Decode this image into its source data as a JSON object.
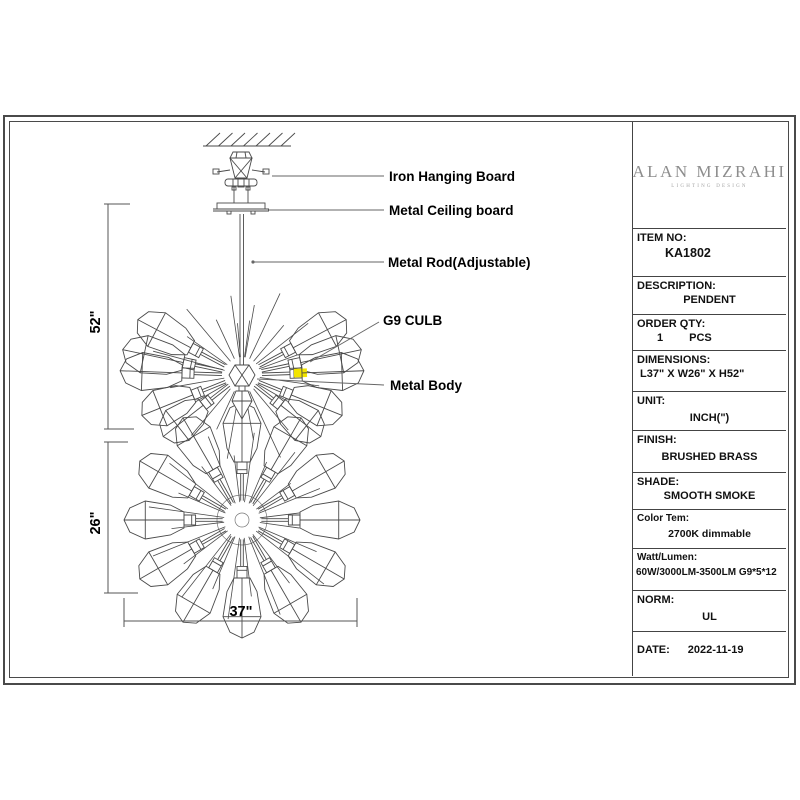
{
  "brand": {
    "name": "ALAN MIZRAHI",
    "tagline": "LIGHTING DESIGN"
  },
  "drawing": {
    "callouts": {
      "hanging_board": "Iron Hanging Board",
      "ceiling_board": "Metal Ceiling board",
      "rod": "Metal Rod(Adjustable)",
      "bulb": "G9 CULB",
      "body": "Metal Body"
    },
    "dimensions": {
      "height": "52\"",
      "depth": "26\"",
      "width": "37\""
    },
    "highlight_color": "#f2e400"
  },
  "spec_table": {
    "rows": [
      {
        "label": "ITEM NO:",
        "value": "KA1802"
      },
      {
        "label": "DESCRIPTION:",
        "value": "PENDENT"
      },
      {
        "label": "ORDER QTY:",
        "value": "1",
        "unit": "PCS"
      },
      {
        "label": "DIMENSIONS:",
        "value": "L37\" X W26\" X H52\""
      },
      {
        "label": "UNIT:",
        "value": "INCH(\")"
      },
      {
        "label": "FINISH:",
        "value": "BRUSHED BRASS"
      },
      {
        "label": "SHADE:",
        "value": "SMOOTH SMOKE"
      },
      {
        "label": "Color Tem:",
        "value": "2700K dimmable"
      },
      {
        "label": "Watt/Lumen:",
        "value": "60W/3000LM-3500LM G9*5*12"
      },
      {
        "label": "NORM:",
        "value": "UL"
      },
      {
        "label": "DATE:",
        "value": "2022-11-19"
      }
    ]
  }
}
